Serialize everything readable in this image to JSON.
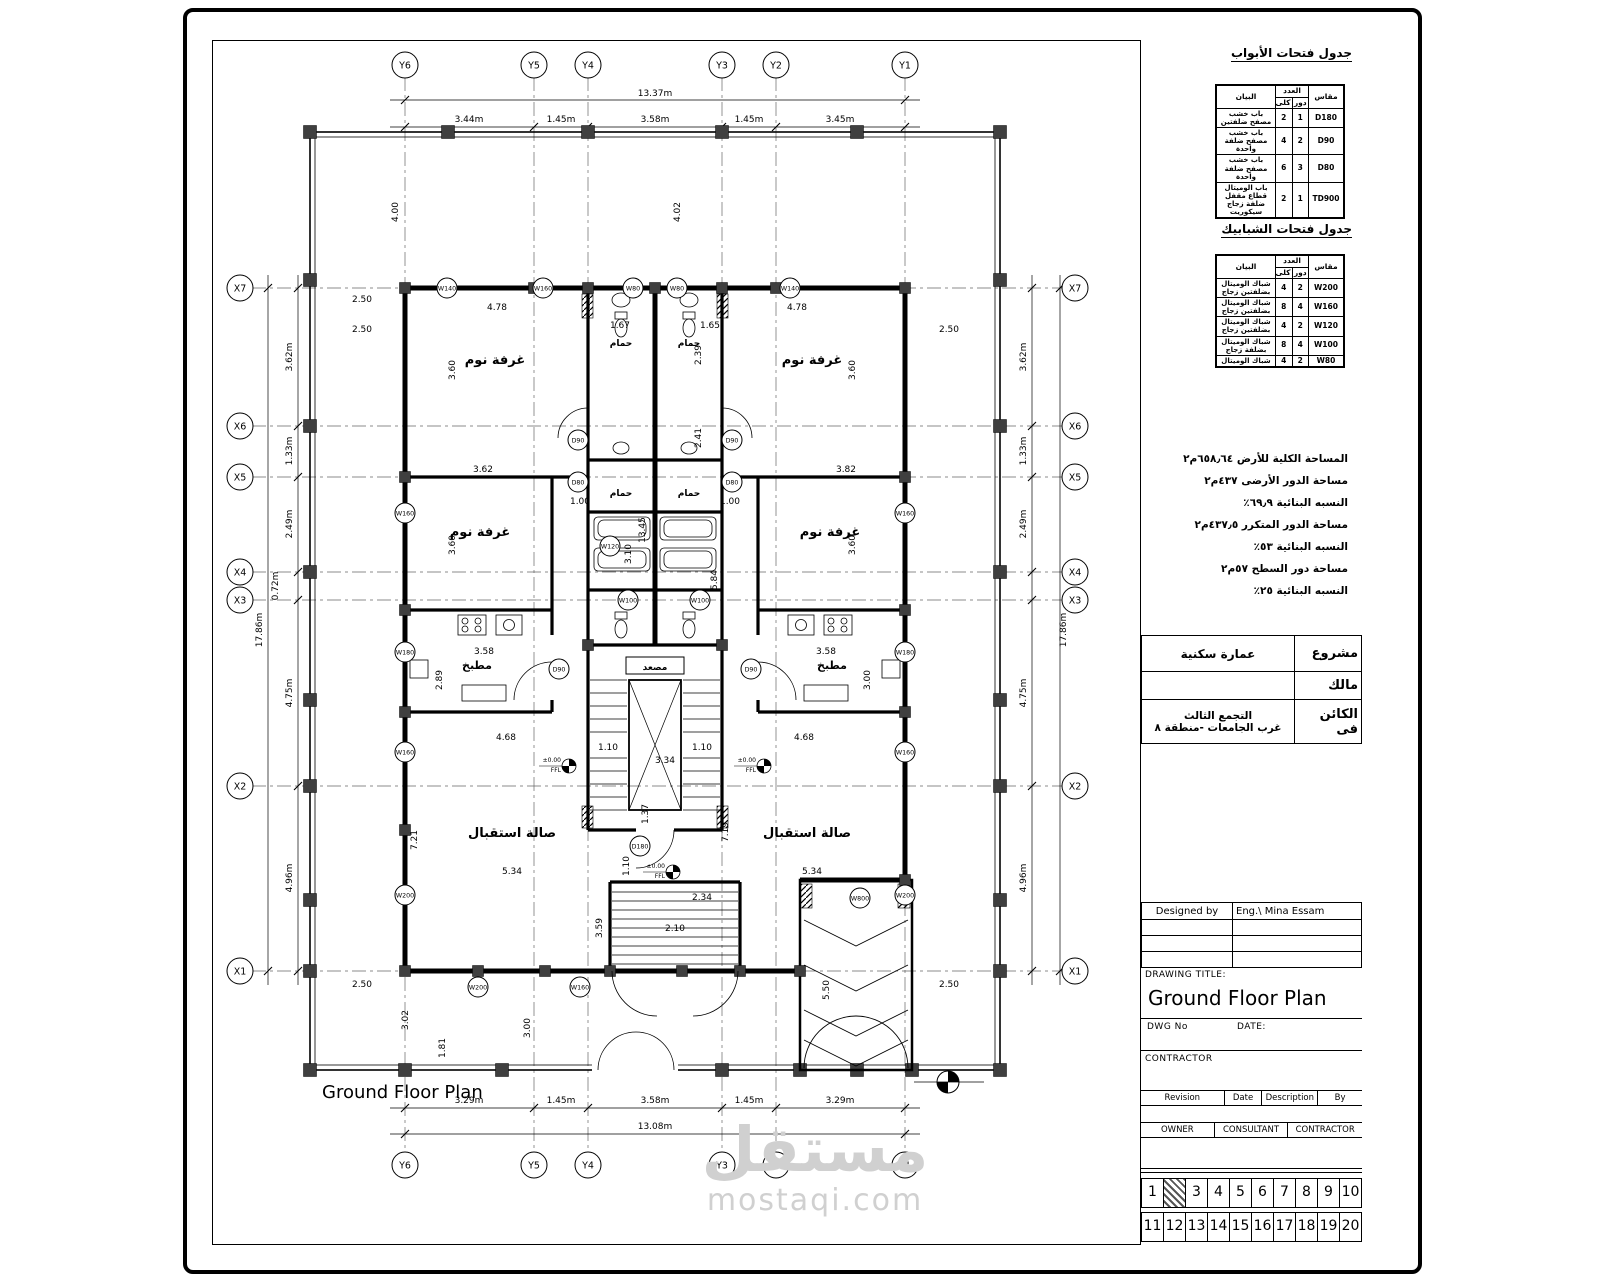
{
  "plan": {
    "caption": "Ground Floor Plan",
    "grid": {
      "y": [
        "Y6",
        "Y5",
        "Y4",
        "Y3",
        "Y2",
        "Y1"
      ],
      "x": [
        "X7",
        "X6",
        "X5",
        "X4",
        "X3",
        "X2",
        "X1"
      ]
    },
    "dims": {
      "d1337": "13.37m",
      "d344": "3.44m",
      "d145": "1.45m",
      "d358m": "3.58m",
      "d345": "3.45m",
      "d1308": "13.08m",
      "d329": "3.29m",
      "d1786": "17.86m",
      "d362m": "3.62m",
      "d133m": "1.33m",
      "d249m": "2.49m",
      "d072m": "0.72m",
      "d475m": "4.75m",
      "d496m": "4.96m",
      "d478": "4.78",
      "d360": "3.60",
      "d362": "3.62",
      "d382": "3.82",
      "d100": "1.00",
      "d250": "2.50",
      "d400": "4.00",
      "d402": "4.02",
      "d167": "1.67",
      "d165": "1.65",
      "d239": "2.39",
      "d241": "2.41",
      "d1345": "13.45",
      "d310": "3.10",
      "d584": "5.84",
      "d358": "3.58",
      "d300": "3.00",
      "d289": "2.89",
      "d468": "4.68",
      "d721": "7.21",
      "d719": "7.19",
      "d534": "5.34",
      "d334": "3.34",
      "d110": "1.10",
      "d137": "1.37",
      "d210": "2.10",
      "d359": "3.59",
      "d234": "2.34",
      "d550": "5.50",
      "d302": "3.02",
      "d181": "1.81"
    },
    "rooms": {
      "bedroom": "غرفة نوم",
      "bath": "حمام",
      "kitchen": "مطبخ",
      "reception": "صالة استقبال",
      "elevator": "مصعد"
    },
    "level": {
      "value": "±0.00",
      "name": "FFL"
    },
    "tags": {
      "w80": "W80",
      "w100": "W100",
      "w120": "W120",
      "w140": "W140",
      "w160": "W160",
      "w180": "W180",
      "w200": "W200",
      "w800": "W800",
      "d80": "D80",
      "d90": "D90",
      "d180": "D180"
    }
  },
  "panel": {
    "door_schedule": {
      "title": "جدول فتحات الأبواب",
      "headers": {
        "desc": "البيان",
        "group": "العدد",
        "sub1": "دور",
        "sub2": "كلى",
        "size": "مقاس"
      },
      "rows": [
        {
          "desc": "باب خشب مصفح ضلفتين",
          "n1": "1",
          "n2": "2",
          "size": "D180"
        },
        {
          "desc": "باب خشب مصفح ضلفة واحدة",
          "n1": "2",
          "n2": "4",
          "size": "D90"
        },
        {
          "desc": "باب خشب مصفح ضلفة واحدة",
          "n1": "3",
          "n2": "6",
          "size": "D80"
        },
        {
          "desc": "باب الوميتال قطاع مقفل ضلفة زجاج سيكوريت",
          "n1": "1",
          "n2": "2",
          "size": "TD900"
        }
      ]
    },
    "window_schedule": {
      "title": "جدول فتحات الشبابيك",
      "headers": {
        "desc": "البيان",
        "group": "العدد",
        "sub1": "دور",
        "sub2": "كلى",
        "size": "مقاس"
      },
      "rows": [
        {
          "desc": "شباك الوميتال بضلفتين زجاج",
          "n1": "2",
          "n2": "4",
          "size": "W200"
        },
        {
          "desc": "شباك الوميتال بضلفتين زجاج",
          "n1": "4",
          "n2": "8",
          "size": "W160"
        },
        {
          "desc": "شباك الوميتال بضلفتين زجاج",
          "n1": "2",
          "n2": "4",
          "size": "W120"
        },
        {
          "desc": "شباك الوميتال بضلفة زجاج",
          "n1": "4",
          "n2": "8",
          "size": "W100"
        },
        {
          "desc": "شباك الوميتال",
          "n1": "2",
          "n2": "4",
          "size": "W80"
        }
      ]
    },
    "stats": [
      "المساحة الكلية للأرض ٦٥٨٫٦٤م٢",
      "مساحة الدور الأرضى ٤٣٧م٢",
      "النسبه البنائية ٦٩٫٩٪",
      "مساحة الدور المتكرر ٤٣٧٫٥م٢",
      "النسبه البنائية ٥٣٪",
      "مساحة دور السطح ٥٧م٢",
      "النسبه البنائية ٢٥٪"
    ],
    "project": {
      "project_label": "مشروع",
      "project_value": "عمارة سكنية",
      "owner_label": "مالك",
      "owner_value": "",
      "location_label": "الكائن فى",
      "location_line1": "التجمع الثالث",
      "location_line2": "غرب الجامعات -منطقة ٨"
    },
    "titleblock": {
      "designed_by_label": "Designed by",
      "designer": "Eng.\\ Mina Essam",
      "drawing_title_label": "DRAWING TITLE:",
      "drawing_title": "Ground Floor Plan",
      "dwg_label": "DWG No",
      "date_label": "DATE:",
      "contractor_label": "CONTRACTOR",
      "revision": "Revision",
      "rev_date": "Date",
      "description": "Description",
      "by": "By",
      "owner": "OWNER",
      "consultant": "CONSULTANT",
      "contractor2": "CONTRACTOR"
    },
    "strip1": [
      "1",
      "2",
      "3",
      "4",
      "5",
      "6",
      "7",
      "8",
      "9",
      "10"
    ],
    "strip2": [
      "11",
      "12",
      "13",
      "14",
      "15",
      "16",
      "17",
      "18",
      "19",
      "20"
    ]
  },
  "watermark": {
    "word": "مستقل",
    "site": "mostaqi.com"
  }
}
